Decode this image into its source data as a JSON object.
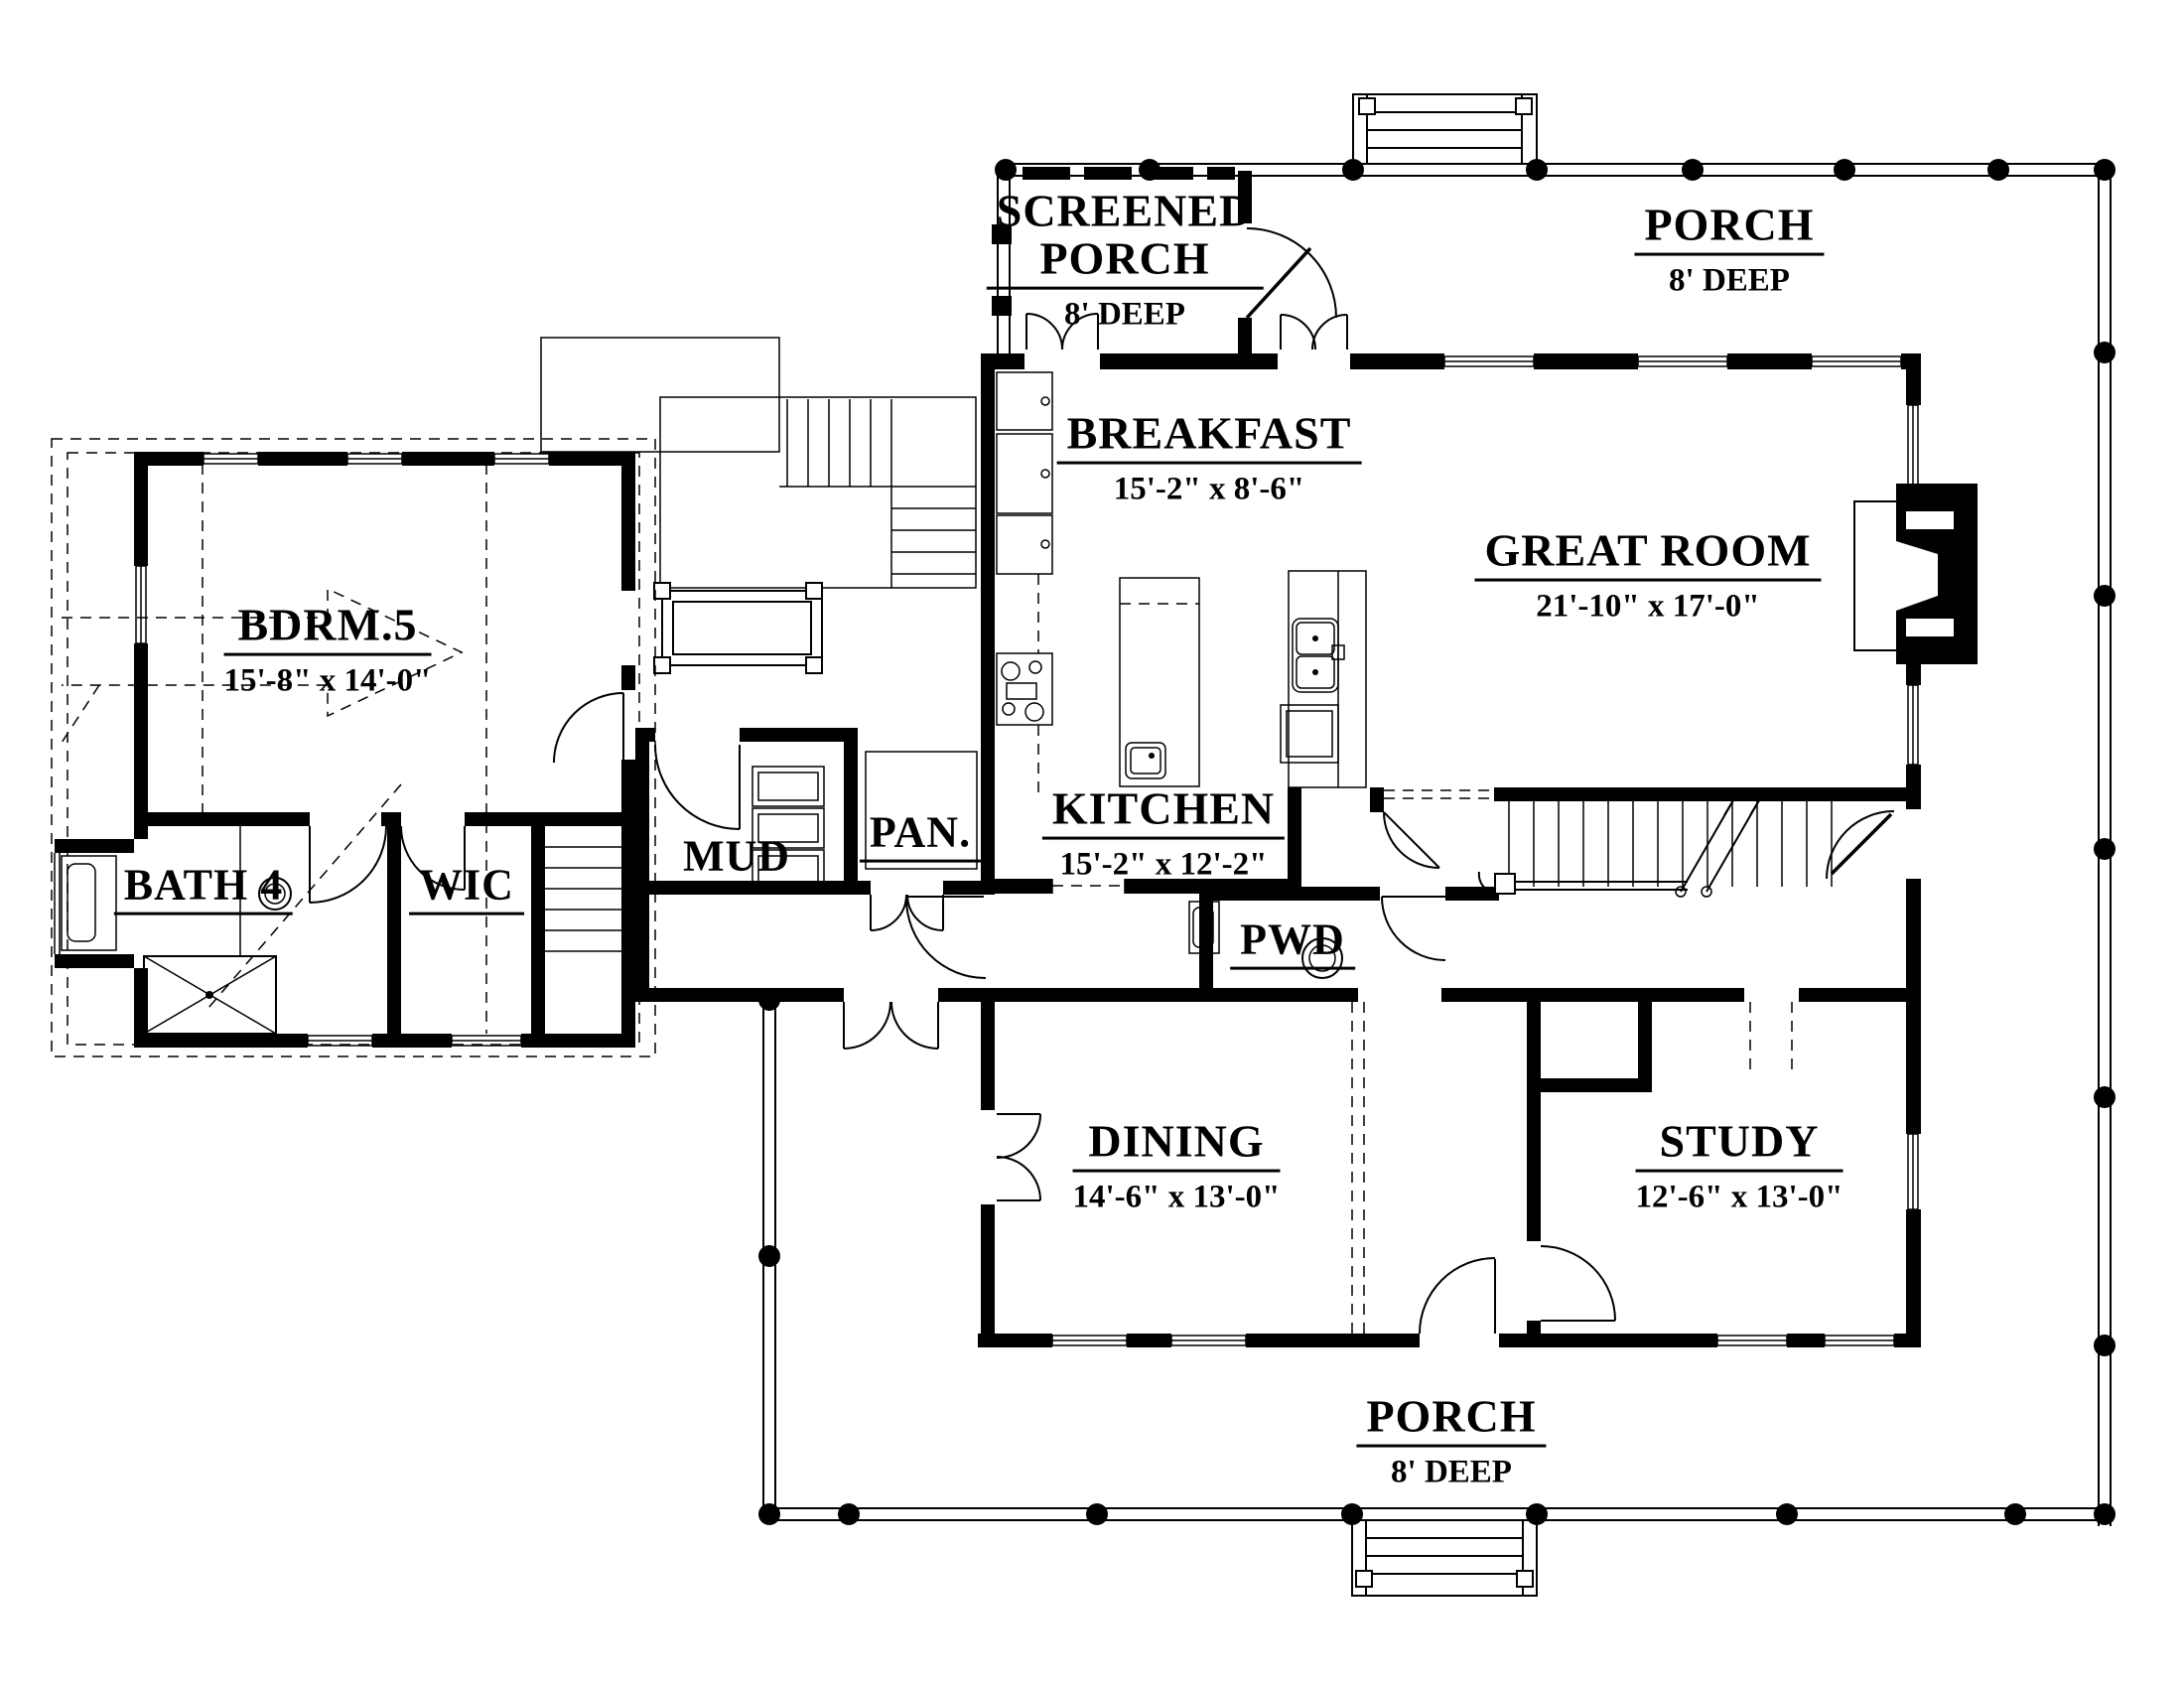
{
  "page": {
    "background": "#ffffff",
    "ink": "#000000"
  },
  "plan": {
    "rooms": {
      "screened_porch": {
        "line1": "SCREENED",
        "line2": "PORCH",
        "dims": "8' DEEP"
      },
      "porch_top": {
        "name": "PORCH",
        "dims": "8' DEEP"
      },
      "breakfast": {
        "name": "BREAKFAST",
        "dims": "15'-2\" x 8'-6\""
      },
      "great_room": {
        "name": "GREAT ROOM",
        "dims": "21'-10\" x 17'-0\""
      },
      "bdrm5": {
        "name": "BDRM.5",
        "dims": "15'-8\" x 14'-0\""
      },
      "bath4": {
        "name": "BATH 4"
      },
      "wic": {
        "name": "WIC"
      },
      "mud": {
        "name": "MUD"
      },
      "pan": {
        "name": "PAN."
      },
      "kitchen": {
        "name": "KITCHEN",
        "dims": "15'-2\" x 12'-2\""
      },
      "pwd": {
        "name": "PWD"
      },
      "dining": {
        "name": "DINING",
        "dims": "14'-6\" x 13'-0\""
      },
      "study": {
        "name": "STUDY",
        "dims": "12'-6\" x 13'-0\""
      },
      "porch_bottom": {
        "name": "PORCH",
        "dims": "8' DEEP"
      }
    }
  }
}
